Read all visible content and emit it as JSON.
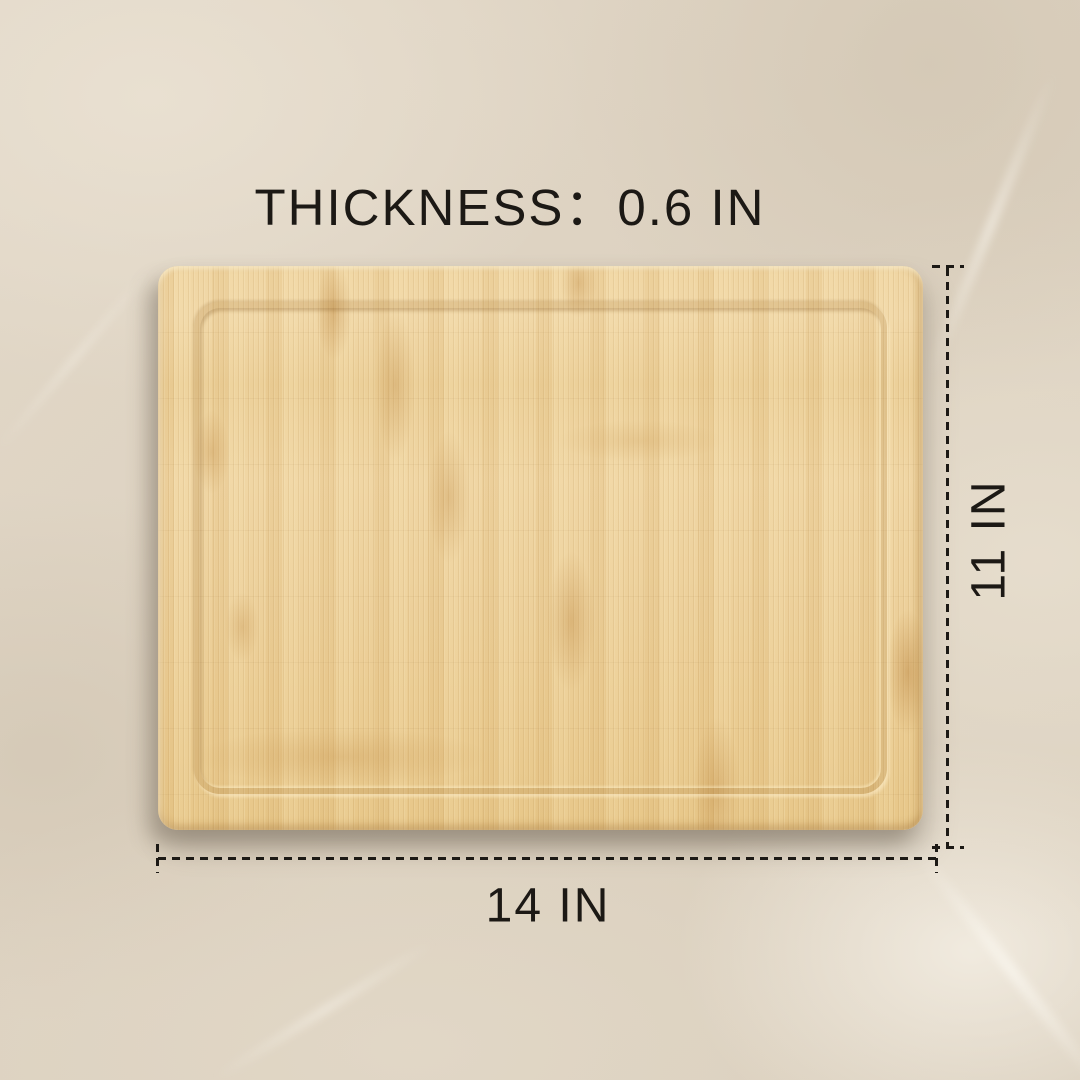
{
  "labels": {
    "thickness": "THICKNESS：0.6 IN",
    "height": "11 IN",
    "width": "14 IN"
  },
  "dimensions": {
    "thickness_in": 0.6,
    "height_in": 11,
    "width_in": 14,
    "unit": "IN"
  },
  "colors": {
    "text": "#1c1915",
    "dimension_line": "#1c1915",
    "background": "#ded3c2",
    "background_light": "#e9e0d1",
    "board_light": "#f0d6a3",
    "board_mid": "#edd19c",
    "board_dark": "#e7c789",
    "groove": "#a97939",
    "knuckle": "#bb853e"
  }
}
